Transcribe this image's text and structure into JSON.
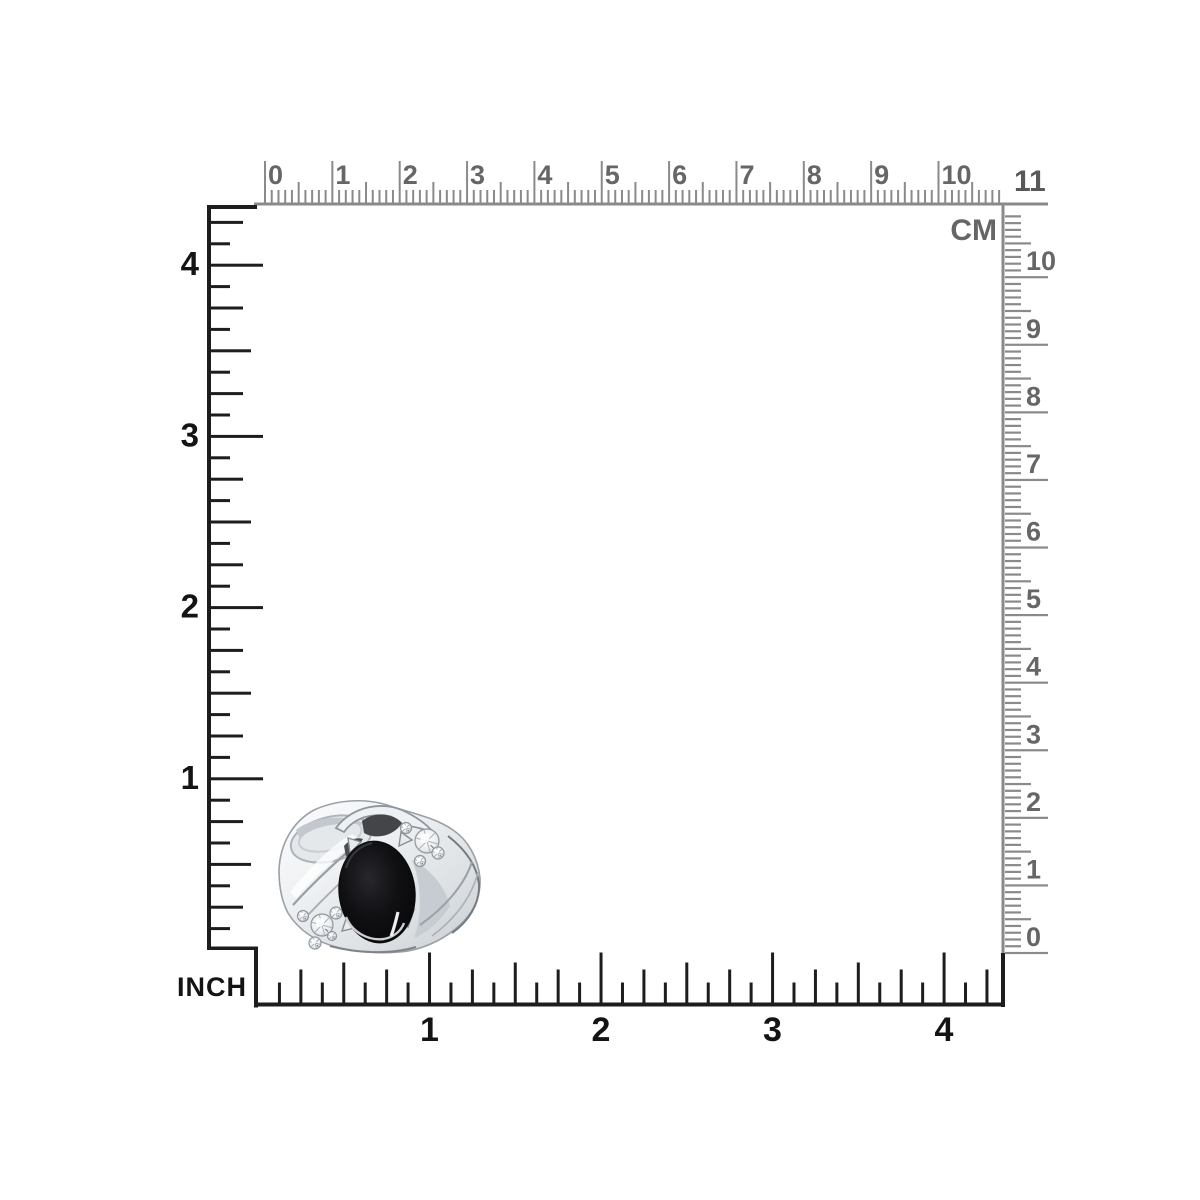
{
  "canvas": {
    "background": "#ffffff"
  },
  "rulers": {
    "cm": {
      "unit_label": "CM",
      "top_labels": [
        "0",
        "1",
        "2",
        "3",
        "4",
        "5",
        "6",
        "7",
        "8",
        "9",
        "10",
        "11"
      ],
      "right_labels": [
        "0",
        "1",
        "2",
        "3",
        "4",
        "5",
        "6",
        "7",
        "8",
        "9",
        "10"
      ],
      "line_color": "#8a8a8a",
      "text_color": "#666666"
    },
    "inch": {
      "unit_label": "INCH",
      "left_labels": [
        "1",
        "2",
        "3",
        "4"
      ],
      "bottom_labels": [
        "1",
        "2",
        "3",
        "4"
      ],
      "line_color": "#1d1d1d",
      "text_color": "#141414"
    }
  },
  "photo": {
    "subject": "silver-ring-black-oval-onyx-with-cz-accents",
    "metal_color": "#e9edf0",
    "metal_shadow_color": "#c6ccd1",
    "stone_color": "#040405",
    "accent_stone_color": "#f2f4f6"
  }
}
